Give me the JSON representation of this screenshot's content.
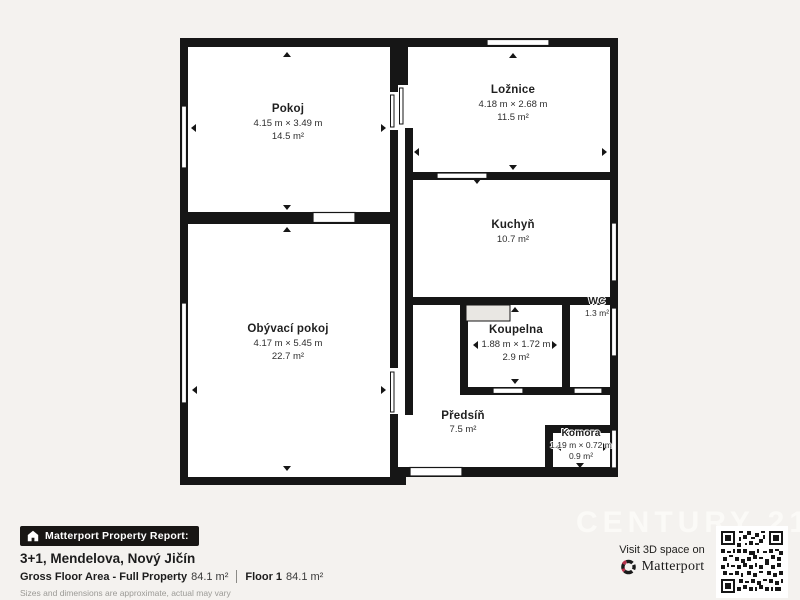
{
  "page": {
    "background_color": "#f4f2ef",
    "wall_color": "#161616",
    "accent_red": "#b5304a"
  },
  "floor_plan": {
    "rooms": [
      {
        "id": "pokoj",
        "name": "Pokoj",
        "dimensions": "4.15 m × 3.49 m",
        "area": "14.5 m²"
      },
      {
        "id": "loznice",
        "name": "Ložnice",
        "dimensions": "4.18 m × 2.68 m",
        "area": "11.5 m²"
      },
      {
        "id": "kuchyn",
        "name": "Kuchyň",
        "dimensions": "",
        "area": "10.7 m²"
      },
      {
        "id": "obyvaci-pokoj",
        "name": "Obývací pokoj",
        "dimensions": "4.17 m × 5.45 m",
        "area": "22.7 m²"
      },
      {
        "id": "koupelna",
        "name": "Koupelna",
        "dimensions": "1.88 m × 1.72 m",
        "area": "2.9 m²"
      },
      {
        "id": "wc",
        "name": "WC",
        "dimensions": "",
        "area": "1.3 m²"
      },
      {
        "id": "predsin",
        "name": "Předsíň",
        "dimensions": "",
        "area": "7.5 m²"
      },
      {
        "id": "komora",
        "name": "Komora",
        "dimensions": "1.19 m × 0.72 m",
        "area": "0.9 m²"
      }
    ]
  },
  "footer": {
    "badge_label": "Matterport Property Report:",
    "title": "3+1, Mendelova, Nový Jičín",
    "gross_label": "Gross Floor Area - Full Property",
    "gross_value": "84.1 m²",
    "floor_label": "Floor 1",
    "floor_value": "84.1 m²",
    "disclaimer": "Sizes and dimensions are approximate, actual may vary"
  },
  "branding": {
    "watermark": "CENTURY 21",
    "visit_text": "Visit 3D space on",
    "matterport_wordmark": "Matterport"
  }
}
